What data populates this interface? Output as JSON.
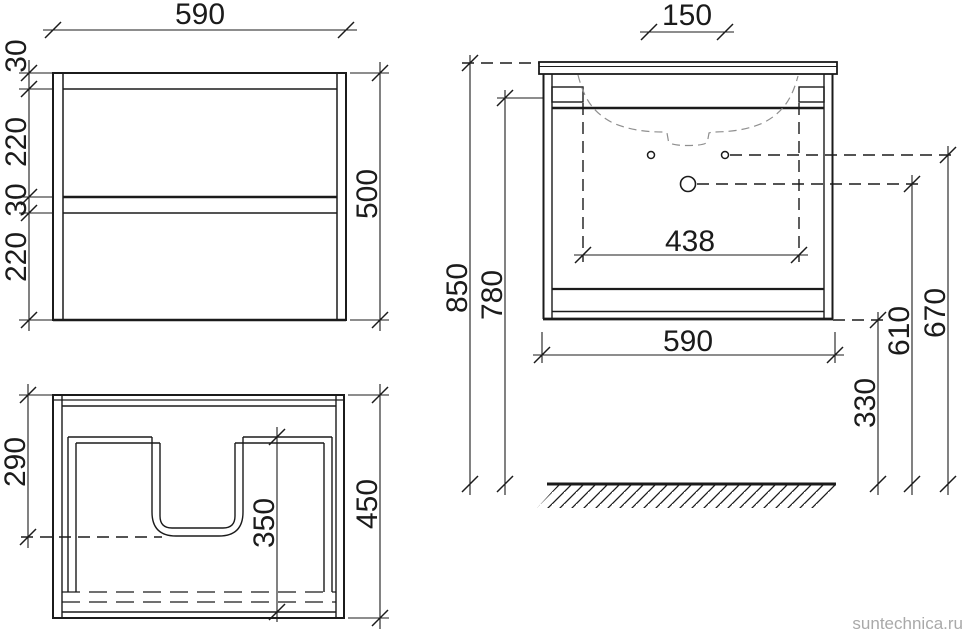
{
  "drawing": {
    "watermark": "suntechnica.ru",
    "views": {
      "front": {
        "dims": {
          "width": "590",
          "height": "500",
          "top_rail": "30",
          "upper_drawer": "220",
          "middle_gap": "30",
          "lower_drawer": "220"
        }
      },
      "plan": {
        "dims": {
          "siphon_cutout": "290",
          "drawer_depth": "350",
          "depth": "450"
        }
      },
      "installation": {
        "dims": {
          "faucet_hole_spacing": "150",
          "total_height": "850",
          "cabinet_top_height": "780",
          "bracket_spacing": "438",
          "width": "590",
          "bottom_clearance": "330",
          "drain_height": "610",
          "supply_height": "670"
        }
      }
    },
    "colors": {
      "line": "#1b1b1b",
      "hidden_line": "#8f8f8f",
      "watermark": "#a9a9a9",
      "background": "#ffffff"
    }
  }
}
